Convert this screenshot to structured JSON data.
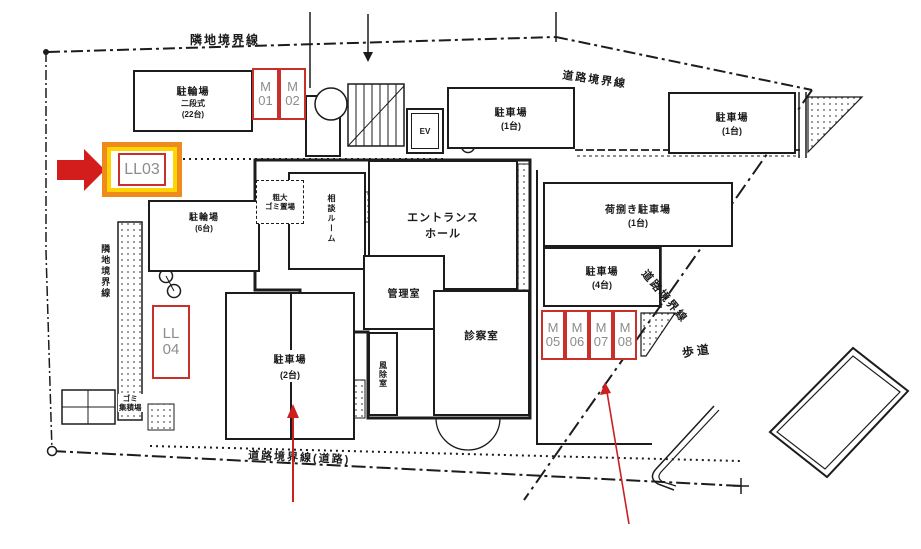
{
  "boundaries": {
    "top": "隣地境界線",
    "top_right": "道路境界線",
    "left": "隣地境界線",
    "diagonal": "道路境界線",
    "bottom": "道路境界線(道路)"
  },
  "areas": {
    "bike_top": {
      "name": "駐輪場",
      "type": "二段式",
      "capacity": "(22台)"
    },
    "bike_left": {
      "name": "駐輪場",
      "capacity": "(6台)"
    },
    "parking_top": {
      "name": "駐車場",
      "capacity": "(1台)"
    },
    "parking_top_right": {
      "name": "駐車場",
      "capacity": "(1台)"
    },
    "loading_parking": {
      "name": "荷捌き駐車場",
      "capacity": "(1台)"
    },
    "parking_right": {
      "name": "駐車場",
      "capacity": "(4台)"
    },
    "parking_center": {
      "name": "駐車場",
      "capacity": "(2台)"
    },
    "sidewalk": "歩道",
    "trash": {
      "line1": "ゴミ",
      "line2": "集積場"
    },
    "bulky_trash": {
      "line1": "粗大",
      "line2": "ゴミ置場"
    }
  },
  "rooms": {
    "entrance_hall": {
      "line1": "エントランス",
      "line2": "ホール"
    },
    "office": "管理室",
    "exam_room": "診察室",
    "windbreak": "風除室",
    "consult_room": "相談ルーム",
    "elevator": "EV"
  },
  "spots": {
    "m01": {
      "line1": "M",
      "line2": "01"
    },
    "m02": {
      "line1": "M",
      "line2": "02"
    },
    "ll03": {
      "label": "LL03",
      "highlighted": true
    },
    "ll04": {
      "line1": "LL",
      "line2": "04"
    },
    "m05": {
      "line1": "M",
      "line2": "05"
    },
    "m06": {
      "line1": "M",
      "line2": "06"
    },
    "m07": {
      "line1": "M",
      "line2": "07"
    },
    "m08": {
      "line1": "M",
      "line2": "08"
    }
  },
  "colors": {
    "plan_line": "#1c1c1c",
    "spot_border": "#c9302c",
    "spot_text": "#8c8c8c",
    "highlight_outer": "#ef8a1c",
    "highlight_inner": "#ffd400",
    "annotation_red": "#d31c1c"
  }
}
